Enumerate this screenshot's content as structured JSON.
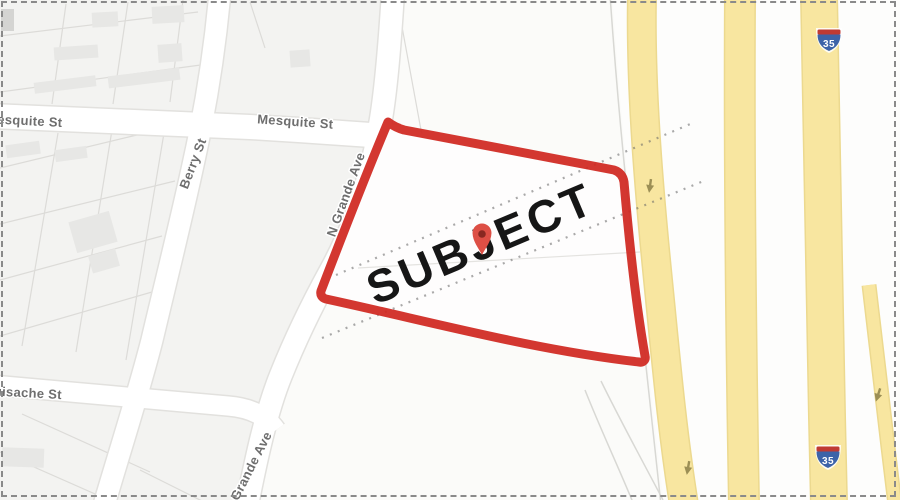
{
  "map": {
    "annotation": {
      "subject_label": "SUBJECT"
    },
    "streets": {
      "mesquite_left": "Mesquite St",
      "mesquite_right": "Mesquite St",
      "berry": "Berry St",
      "n_grande": "N Grande Ave",
      "huisache": "Huisache St",
      "grande_lower": "N Grande Ave"
    },
    "shields": [
      {
        "label": "35"
      },
      {
        "label": "35"
      }
    ],
    "colors": {
      "subject_outline": "#d02820",
      "subject_text": "#161616",
      "pin": "#dd4f45",
      "pin_dot": "#7e241d",
      "highway_fill": "#f8e6a0",
      "highway_edge": "#ecd98f",
      "road_fill": "#ffffff",
      "map_background": "#f3f3f1",
      "street_label": "#6e6e6e",
      "shield_blue": "#3d63a8",
      "shield_red": "#bf3a33",
      "border_dash": "#8a8a8a"
    },
    "icons": {
      "pin": "location-pin",
      "arrow": "one-way-arrow-down",
      "shield": "interstate-shield"
    }
  }
}
